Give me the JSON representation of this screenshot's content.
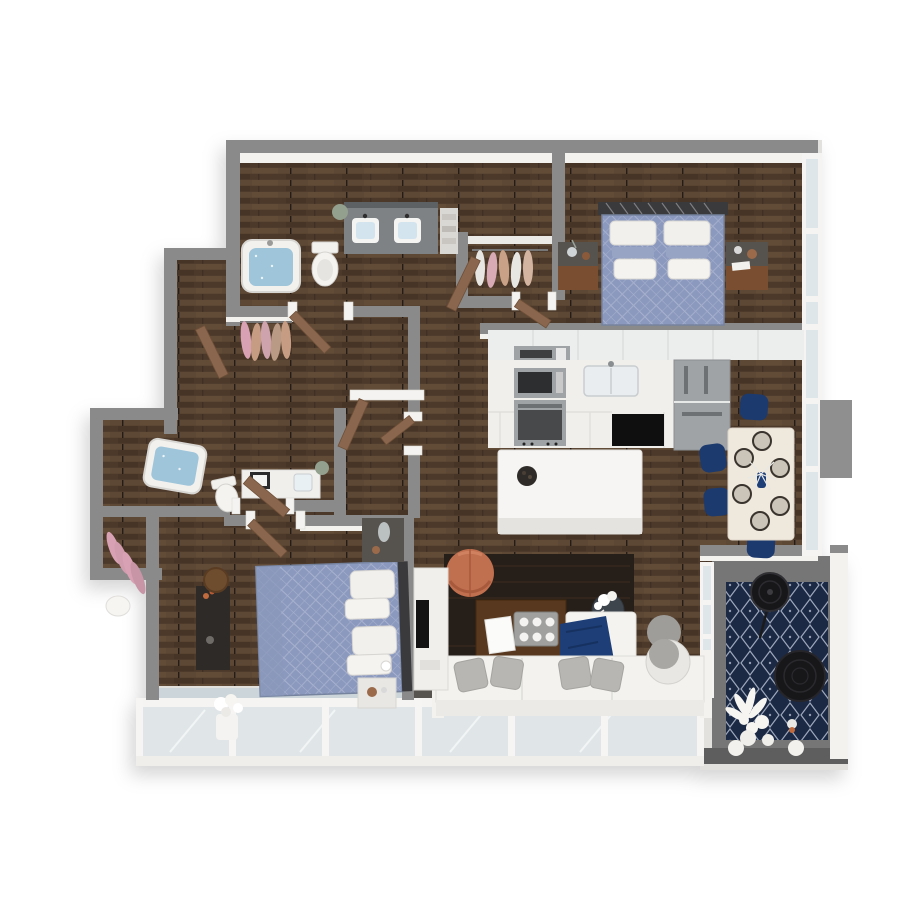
{
  "scene": {
    "type": "3d-floor-plan-render",
    "view": "overhead isometric dollhouse view, white background, soft shadow",
    "unit_summary": "Two-bedroom, two-bathroom apartment with open kitchen/living/dining, hallway closets, glass-railed balcony and furnished corner terrace",
    "palette": {
      "background": "#ffffff",
      "floor_wood": "#55402f",
      "floor_wood_light": "#634c38",
      "floor_wood_dark": "#473526",
      "wall_cap": "#8a8a8a",
      "wall_face": "#f3f2ef",
      "furniture_white": "#f3f2ef",
      "door_wood": "#8a664e",
      "door_frame": "#f4f3f1",
      "glass": "#dfe6ea",
      "water_blue": "#9ec5da",
      "tub_white": "#f2f1ee",
      "duvet_blue": "#8c99be",
      "duvet_line": "#a8b2cf",
      "pillow_white": "#f1f0ed",
      "sham_blue": "#98a4c4",
      "headboard_dark": "#3a3a3c",
      "nightstand_wood": "#7a4e30",
      "nightstand_top": "#56524e",
      "kitchen_white": "#eceeed",
      "counter_white": "#f0efec",
      "appliance_steel": "#9fa3a6",
      "appliance_dark": "#3c3e40",
      "dishwasher_black": "#0f0f10",
      "island_white": "#f6f5f3",
      "dining_table": "#efe8dc",
      "chair_navy": "#1d3a6e",
      "plate_ring": "#3a342e",
      "rug_dark": "#261e18",
      "coffee_table_wood": "#58381f",
      "pouf_copper": "#c06f4f",
      "sofa_white": "#f3f2ef",
      "pillow_gray": "#b7b6b3",
      "throw_navy": "#1e3e78",
      "ottoman_gray": "#9e9d9a",
      "tv_screen": "#131314",
      "terrace_floor": "#767676",
      "terrace_slab": "#5e5e5e",
      "terrace_rug_navy": "#1c2944",
      "terrace_rug_line": "#c9d2e4",
      "wicker_black": "#17171a",
      "plant_white": "#f6f5f2",
      "plant_green": "#93a08e",
      "clothes_pink": "#d8a2b4",
      "clothes_tan": "#c69d83",
      "accent_flower_orange": "#c06a3e"
    },
    "rooms": [
      {
        "name": "bathroom-1",
        "position": "top-left",
        "furniture": [
          "bathtub-with-water",
          "toilet",
          "double-sink-vanity",
          "mirror",
          "plant",
          "towel-shelf"
        ]
      },
      {
        "name": "hallway-closets",
        "position": "center-left",
        "furniture": [
          "hanging-clothes-tan-pink",
          "hanging-clothes-nook",
          "open-interior-doors"
        ]
      },
      {
        "name": "primary-bedroom",
        "position": "top-right",
        "furniture": [
          "double-bed-blue-diamond-duvet",
          "metal-lattice-headboard",
          "white-pillows",
          "blue-shams",
          "nightstand-left",
          "nightstand-right",
          "decor-vases"
        ]
      },
      {
        "name": "kitchen",
        "position": "center-right",
        "furniture": [
          "upper-cabinets",
          "range-hood-microwave",
          "wall-oven",
          "sink",
          "black-dishwasher",
          "stainless-refrigerator",
          "white-island",
          "dark-fruit-bowl"
        ]
      },
      {
        "name": "dining-area",
        "position": "right",
        "furniture": [
          "white-dining-table",
          "six-place-settings",
          "navy-chairs-x4",
          "navy-vase-centerpiece"
        ]
      },
      {
        "name": "living-room",
        "position": "center",
        "furniture": [
          "dark-area-rug",
          "wood-coffee-table",
          "serving-tray-with-bowls",
          "white-book",
          "copper-pouf",
          "round-side-table-flowers",
          "white-sofa",
          "gray-pillows",
          "white-chaise",
          "navy-throw-blanket",
          "gray-ottoman",
          "white-cylinder-table",
          "tv-console",
          "tv"
        ]
      },
      {
        "name": "bathroom-2",
        "position": "mid-left",
        "furniture": [
          "bathtub-with-water",
          "toilet",
          "vanity-with-art",
          "plant"
        ]
      },
      {
        "name": "walk-in-closet",
        "position": "mid-left-lower",
        "furniture": [
          "hanging-clothes-pink",
          "white-basket"
        ]
      },
      {
        "name": "bedroom-2",
        "position": "bottom-left",
        "furniture": [
          "double-bed-blue-diamond-duvet",
          "white-pillows",
          "dark-headboard",
          "nightstand-north",
          "bedside-table-south",
          "dark-dresser",
          "orange-flowers",
          "round-wood-stool"
        ]
      },
      {
        "name": "balcony",
        "position": "bottom",
        "furniture": [
          "glass-railing-panels",
          "white-flower-pot"
        ]
      },
      {
        "name": "terrace",
        "position": "bottom-right",
        "furniture": [
          "navy-moroccan-rug",
          "black-standing-fan",
          "black-round-wicker-chair",
          "white-plants",
          "round-side-tables"
        ]
      }
    ],
    "counts": {
      "bedrooms": 2,
      "bathrooms": 2,
      "dining_chairs_visible": 4,
      "place_settings": 6,
      "bathtubs": 2
    }
  }
}
